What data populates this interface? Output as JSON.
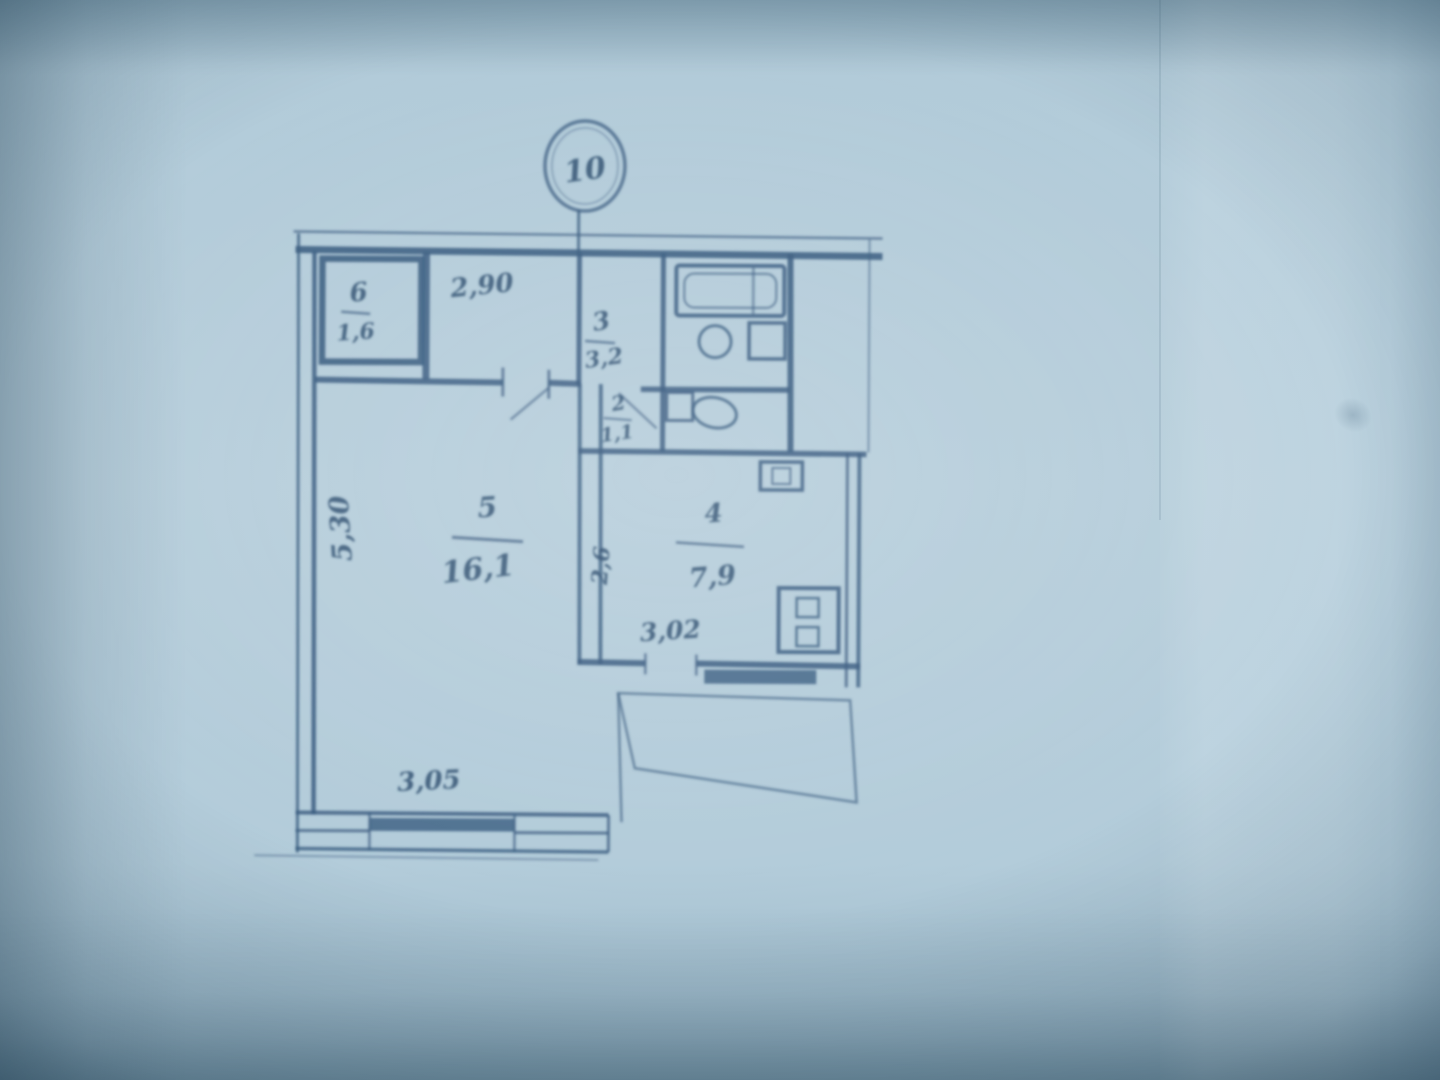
{
  "photo": {
    "paper_color": "#b8cfdc",
    "ink_color": "#3a5c80"
  },
  "plan": {
    "riser_number": "10",
    "rooms": {
      "closet": {
        "number": "6",
        "area": "1,6"
      },
      "corridor": {
        "number": "3",
        "area": "3,2"
      },
      "toilet": {
        "number": "2",
        "area": "1,1"
      },
      "living": {
        "number": "5",
        "area": "16,1"
      },
      "kitchen": {
        "number": "4",
        "area": "7,9"
      }
    },
    "dimensions": {
      "hall_width": "2,90",
      "living_depth": "5,30",
      "living_width": "3,05",
      "kitchen_depth": "2,6",
      "kitchen_width": "3,02"
    }
  }
}
